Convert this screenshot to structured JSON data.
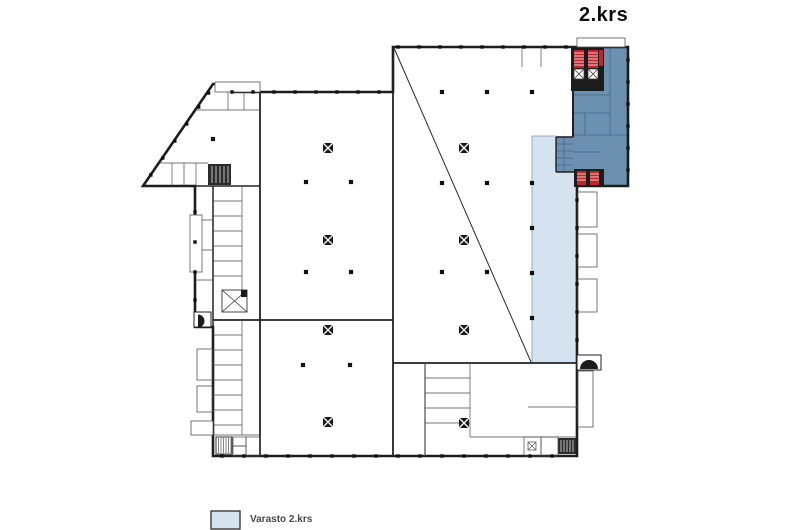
{
  "title": "2.krs",
  "legend": {
    "label": "Varasto 2.krs",
    "swatch_color": "#d4e3ef"
  },
  "plan": {
    "colors": {
      "storage_fill": "#d4e3ef",
      "storage_border": "#93abbf",
      "rented_fill": "#6b90b0",
      "rented_border": "#3f5f7a",
      "stair_red": "#c0272d",
      "wall": "#1d1d1d"
    }
  }
}
